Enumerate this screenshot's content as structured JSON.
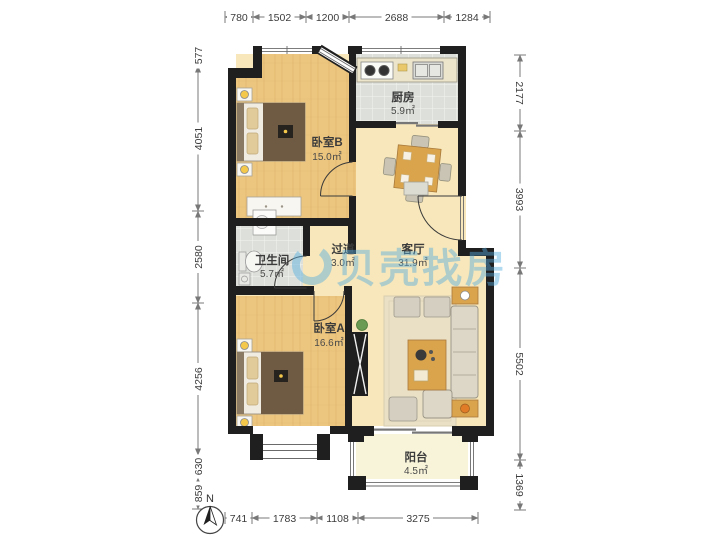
{
  "watermark": {
    "text": "贝壳找房"
  },
  "compass": {
    "label": "N"
  },
  "rooms": {
    "bedroom_b": {
      "name": "卧室B",
      "area": "15.0㎡"
    },
    "kitchen": {
      "name": "厨房",
      "area": "5.9㎡"
    },
    "bathroom": {
      "name": "卫生间",
      "area": "5.7㎡"
    },
    "hallway": {
      "name": "过道",
      "area": "3.0㎡"
    },
    "living": {
      "name": "客厅",
      "area": "31.9㎡"
    },
    "bedroom_a": {
      "name": "卧室A",
      "area": "16.6㎡"
    },
    "balcony": {
      "name": "阳台",
      "area": "4.5㎡"
    }
  },
  "dimensions": {
    "top": [
      "780",
      "1502",
      "1200",
      "2688",
      "1284"
    ],
    "bottom": [
      "741",
      "1783",
      "1108",
      "3275"
    ],
    "left": [
      "577",
      "4051",
      "2580",
      "4256",
      "630",
      "859"
    ],
    "right": [
      "2177",
      "3993",
      "5502",
      "1369"
    ]
  },
  "colors": {
    "wall": "#1f1f1f",
    "wood": "#ecc57e",
    "cream": "#f7e7ba",
    "tile": "#dde0da",
    "balcony": "#f8f4da",
    "wm": "#55acde",
    "furnwood": "#d9a44c"
  }
}
